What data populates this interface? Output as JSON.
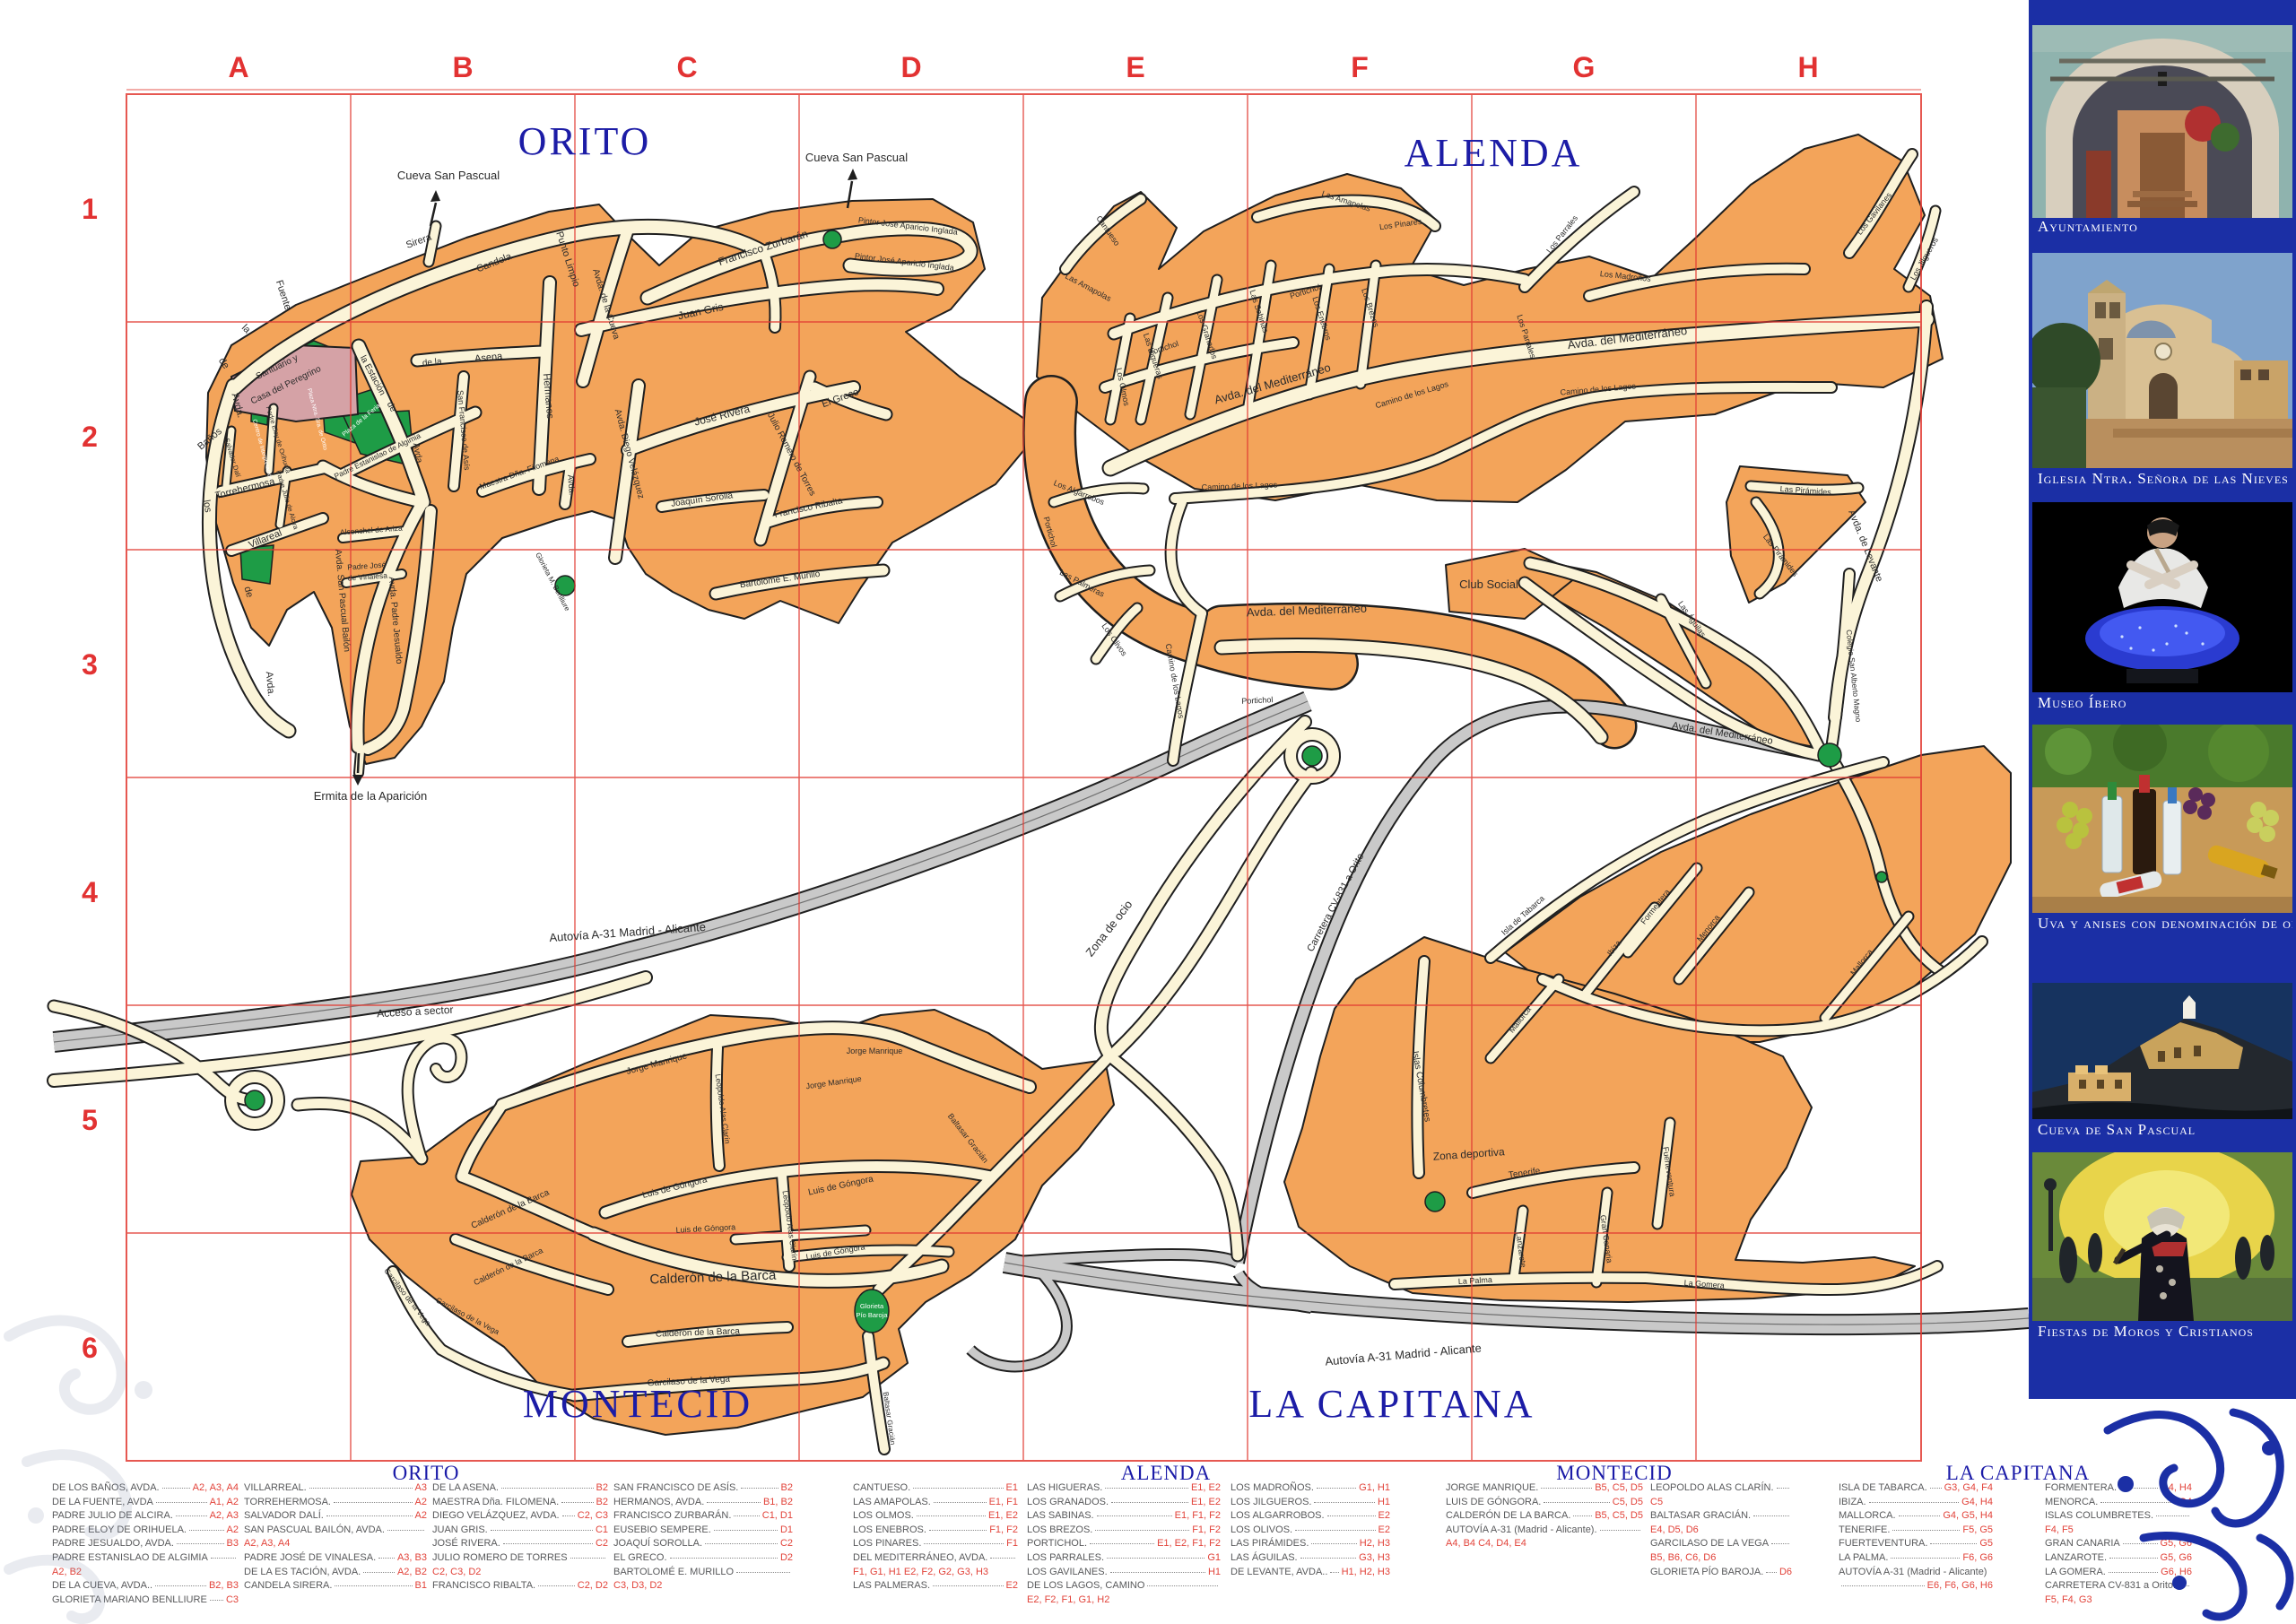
{
  "grid": {
    "columns": [
      "A",
      "B",
      "C",
      "D",
      "E",
      "F",
      "G",
      "H"
    ],
    "rows": [
      "1",
      "2",
      "3",
      "4",
      "5",
      "6"
    ]
  },
  "districts": {
    "orito": "ORITO",
    "alenda": "ALENDA",
    "montecid": "MONTECID",
    "capitana": "LA CAPITANA"
  },
  "colors": {
    "block_orange": "#F3A45A",
    "road_cream": "#FBF4D8",
    "grid_red": "#E23B33",
    "title_blue": "#1c1ca6",
    "park_green": "#1E9C46",
    "building_pink": "#D5A2A6",
    "highway_gray": "#C9C9C9",
    "sidebar_blue": "#1B2FA5",
    "index_ref_red": "#E2433A"
  },
  "map_labels": {
    "orito": {
      "cueva1": "Cueva San Pascual",
      "cueva2": "Cueva San Pascual",
      "sirera": "Sirera",
      "candela": "Candela",
      "punto": "Punto Limpio",
      "fzurbaran": "Francisco Zurbarán",
      "pintor1": "Pintor José Aparicio Inglada",
      "pintor2": "Pintor José Aparicio Inglada",
      "juangris": "Juan Gris",
      "cueva_av": "Avda. de la Cueva",
      "hermanos": "Hermanos",
      "asena": "Asena",
      "dela": "de la",
      "sanfran": "San Francisco de Asís",
      "maestra": "Maestra Dña. Filomena",
      "avda_c2": "Avda.",
      "joserivera": "José Rivera",
      "dvelazquez": "Avda. Diego Velázquez",
      "jromero": "Julio Romero de Torres",
      "elgreco": "El Greco",
      "fribalta": "Francisco Ribalta",
      "jsorolla": "Joaquín Sorolla",
      "bmurillo": "Bartolomé E. Murillo",
      "globen": "Glorieta M. Benlliure",
      "santuario_1": "Santuario y",
      "santuario_2": "Casa del Peregrino",
      "plazaferia": "Plaza de la Feria",
      "plazaorito": "Plaza Ntra. Sra. de Orito",
      "centro": "Centro de Interpretación",
      "fuente": "Fuente",
      "la2": "la",
      "de2": "de",
      "avda2": "Avda.",
      "banos": "Baños",
      "los2": "los",
      "de3": "de",
      "avda3": "Avda.",
      "torre": "Torrehermosa",
      "villareal": "Villareal",
      "spb": "Avda. San Pascual Bailón",
      "pjesualdo": "Avda. Padre Jesualdo",
      "alconchel": "Alconchel de Ariza",
      "vinalesa_1": "Padre José",
      "vinalesa_2": "de Vinalesa",
      "estanislao": "Padre Estanislao de Algimia",
      "eloy": "Padre Eloy de Orihuela",
      "dali": "Salvador Dalí",
      "alcira": "Padre Julio de Alcira",
      "estacion": "la Estación",
      "de4": "de",
      "avda4": "Avda.",
      "ermita": "Ermita de la Aparición"
    },
    "alenda": {
      "cantueso": "Cantueso",
      "amapolas1": "Las Amapolas",
      "amapolas2": "Las Amapolas",
      "higueras": "Las Higueras",
      "granados": "Los Granados",
      "sabinas": "Las Sabinas",
      "enebros": "Los Enebros",
      "brezos": "Los Brezos",
      "olmos": "Los Olmos",
      "pinares": "Los Pinares",
      "portichol1": "Portichol",
      "portichol2": "Portichol",
      "portichol3": "Portichol",
      "portichol4": "Portichol",
      "medit1": "Avda. del Mediterráneo",
      "medit2": "Avda. del Mediterráneo",
      "medit3": "Avda. del Mediterráneo",
      "medit4": "Avda. del Mediterráneo",
      "camino1": "Camino de los Lagos",
      "camino2": "Camino de los Lagos",
      "camino3": "Camino de los Lagos",
      "camino4": "Camino de los Lagos",
      "parrales1": "Los Parrales",
      "parrales2": "Los Parrales",
      "madronos": "Los Madroños",
      "gavilanes": "Los Gavilanes",
      "jilgueros": "Los Jilgueros",
      "algarrobos": "Los Algarrobos",
      "palmeras": "Las Palmeras",
      "olivos": "Los Olivos",
      "club": "Club Social",
      "piramides1": "Las Pirámides",
      "piramides2": "Las Pirámides",
      "levante": "Avda. de Levante",
      "aguilas": "Las Águilas",
      "colegio": "Colegio San Alberto Magno"
    },
    "montecid": {
      "autovia1": "Autovía A-31 Madrid - Alicante",
      "acceso": "Acceso a sector",
      "zonaocio": "Zona de ocio",
      "jorge1": "Jorge Manrique",
      "jorge2": "Jorge Manrique",
      "jorge3": "Jorge Manrique",
      "leopoldo1": "Leopoldo Alas Clarín",
      "leopoldo2": "Leopoldo Alas Clarín",
      "gongora1": "Luis de Góngora",
      "gongora2": "Luis de Góngora",
      "gongora3": "Luis de Góngora",
      "gongora4": "Luis de Góngora",
      "calderon1": "Calderón de la Barca",
      "calderon2": "Calderón de la Barca",
      "calderon3": "Calderón de la Barca",
      "calderon4": "Calderón de la Barca",
      "garcilaso1": "Garcilaso de la Vega",
      "garcilaso2": "Garcilaso de la Vega",
      "garcilaso3": "Garcilaso de la Vega",
      "baltasar1": "Baltasar Gracián",
      "baltasar2": "Baltasar Gracián",
      "gpb_1": "Glorieta",
      "gpb_2": "Pío Baroja"
    },
    "capitana": {
      "carretera": "Carretera CV-831 a Orito",
      "tabarca": "Isla de Tabarca",
      "formentera": "Formentera",
      "ibiza": "Ibiza",
      "menorca": "Menorca",
      "mallorca1": "Mallorca",
      "mallorca2": "Mallorca",
      "columbretes": "Islas Columbretes",
      "zonadep": "Zona deportiva",
      "tenerife": "Tenerife",
      "lanzarote": "Lanzarote",
      "grancanaria": "Gran Canaria",
      "fuerteventura": "Fuerteventura",
      "lapalma": "La Palma",
      "lagomera": "La Gomera",
      "autovia2": "Autovía A-31 Madrid - Alicante"
    }
  },
  "index": {
    "orito": [
      [
        {
          "n": "DE LOS BAÑOS, AVDA.",
          "r": "A2, A3, A4"
        },
        {
          "n": "DE LA FUENTE, AVDA",
          "r": "A1, A2"
        },
        {
          "n": "PADRE JULIO DE ALCIRA.",
          "r": "A2, A3"
        },
        {
          "n": "PADRE ELOY DE ORIHUELA.",
          "r": "A2"
        },
        {
          "n": "PADRE JESUALDO, AVDA.",
          "r": "B3"
        },
        {
          "n": "PADRE ESTANISLAO DE ALGIMIA",
          "r": "A2, B2"
        },
        {
          "n": "DE LA CUEVA, AVDA..",
          "r": "B2, B3"
        },
        {
          "n": "GLORIETA MARIANO BENLLIURE",
          "r": "C3"
        }
      ],
      [
        {
          "n": "VILLARREAL.",
          "r": "A3"
        },
        {
          "n": "TORREHERMOSA.",
          "r": "A2"
        },
        {
          "n": "SALVADOR DALÍ.",
          "r": "A2"
        },
        {
          "n": "SAN PASCUAL BAILÓN, AVDA.",
          "r": "A2, A3, A4"
        },
        {
          "n": "PADRE JOSÉ DE VINALESA.",
          "r": "A3, B3"
        },
        {
          "n": "DE LA ES TACIÓN, AVDA.",
          "r": "A2, B2"
        },
        {
          "n": "CANDELA SIRERA.",
          "r": "B1"
        }
      ],
      [
        {
          "n": "DE LA ASENA.",
          "r": "B2"
        },
        {
          "n": "MAESTRA Dña. FILOMENA.",
          "r": "B2"
        },
        {
          "n": "DIEGO VELÁZQUEZ, AVDA.",
          "r": "C2, C3"
        },
        {
          "n": "JUAN GRIS.",
          "r": "C1"
        },
        {
          "n": "JOSÉ RIVERA.",
          "r": "C2"
        },
        {
          "n": "JULIO ROMERO DE TORRES",
          "r": "C2, C3, D2"
        },
        {
          "n": "FRANCISCO RIBALTA.",
          "r": "C2, D2"
        }
      ],
      [
        {
          "n": "SAN FRANCISCO DE ASÍS.",
          "r": "B2"
        },
        {
          "n": "HERMANOS, AVDA.",
          "r": "B1, B2"
        },
        {
          "n": "FRANCISCO ZURBARÁN.",
          "r": "C1, D1"
        },
        {
          "n": "EUSEBIO SEMPERE.",
          "r": "D1"
        },
        {
          "n": "JOAQUÍ SOROLLA.",
          "r": "C2"
        },
        {
          "n": "EL GRECO.",
          "r": "D2"
        },
        {
          "n": "BARTOLOMÉ E. MURILLO",
          "r": "C3, D3, D2"
        }
      ]
    ],
    "alenda": [
      [
        {
          "n": "CANTUESO.",
          "r": "E1"
        },
        {
          "n": "LAS AMAPOLAS.",
          "r": "E1, F1"
        },
        {
          "n": "LOS OLMOS.",
          "r": "E1, E2"
        },
        {
          "n": "LOS ENEBROS.",
          "r": "F1, F2"
        },
        {
          "n": "LOS PINARES.",
          "r": "F1"
        },
        {
          "n": "DEL MEDITERRÁNEO, AVDA.",
          "r": "F1, G1, H1 E2, F2, G2, G3, H3"
        },
        {
          "n": "LAS PALMERAS.",
          "r": "E2"
        }
      ],
      [
        {
          "n": "LAS HIGUERAS.",
          "r": "E1, E2"
        },
        {
          "n": "LOS GRANADOS.",
          "r": "E1, E2"
        },
        {
          "n": "LAS SABINAS.",
          "r": "E1, F1, F2"
        },
        {
          "n": "LOS BREZOS.",
          "r": "F1, F2"
        },
        {
          "n": "PORTICHOL.",
          "r": "E1, E2, F1, F2"
        },
        {
          "n": "LOS PARRALES.",
          "r": "G1"
        },
        {
          "n": "LOS GAVILANES.",
          "r": "H1"
        },
        {
          "n": "DE LOS LAGOS, CAMINO",
          "r": "E2, F2, F1, G1, H2"
        }
      ],
      [
        {
          "n": "LOS MADROÑOS.",
          "r": "G1, H1"
        },
        {
          "n": "LOS JILGUEROS.",
          "r": "H1"
        },
        {
          "n": "LOS ALGARROBOS.",
          "r": "E2"
        },
        {
          "n": "LOS OLIVOS.",
          "r": "E2"
        },
        {
          "n": "LAS PIRÁMIDES.",
          "r": "H2, H3"
        },
        {
          "n": "LAS ÁGUILAS.",
          "r": "G3, H3"
        },
        {
          "n": "DE LEVANTE, AVDA..",
          "r": "H1, H2, H3"
        }
      ]
    ],
    "montecid": [
      [
        {
          "n": "JORGE MANRIQUE.",
          "r": "B5, C5, D5"
        },
        {
          "n": "LUIS DE GÓNGORA.",
          "r": "C5, D5"
        },
        {
          "n": "CALDERÓN DE LA BARCA.",
          "r": "B5, C5, D5"
        },
        {
          "n": "AUTOVÍA A-31 (Madrid - Alicante).",
          "r": "A4, B4 C4, D4, E4"
        }
      ],
      [
        {
          "n": "LEOPOLDO ALAS CLARÍN.",
          "r": "C5"
        },
        {
          "n": "BALTASAR GRACIÁN.",
          "r": "E4, D5, D6"
        },
        {
          "n": "GARCILASO DE LA VEGA",
          "r": "B5, B6, C6, D6"
        },
        {
          "n": "GLORIETA PÍO BAROJA.",
          "r": "D6"
        }
      ]
    ],
    "capitana": [
      [
        {
          "n": "ISLA DE TABARCA.",
          "r": "G3, G4, F4"
        },
        {
          "n": "IBIZA.",
          "r": "G4, H4"
        },
        {
          "n": "MALLORCA.",
          "r": "G4, G5, H4"
        },
        {
          "n": "TENERIFE.",
          "r": "F5, G5"
        },
        {
          "n": "FUERTEVENTURA.",
          "r": "G5"
        },
        {
          "n": "LA PALMA.",
          "r": "F6, G6"
        },
        {
          "n": "AUTOVÍA A-31 (Madrid - Alicante)",
          "r": "E6, F6, G6, H6"
        }
      ],
      [
        {
          "n": "FORMENTERA.",
          "r": "G4, H4"
        },
        {
          "n": "MENORCA.",
          "r": "G4"
        },
        {
          "n": "ISLAS COLUMBRETES.",
          "r": "F4, F5"
        },
        {
          "n": "GRAN CANARIA",
          "r": "G5, G6"
        },
        {
          "n": "LANZAROTE.",
          "r": "G5, G6"
        },
        {
          "n": "LA GOMERA.",
          "r": "G6, H6"
        },
        {
          "n": "CARRETERA CV-831 a Orito.",
          "r": "F5, F4, G3"
        }
      ]
    ]
  },
  "sidebar": {
    "panels": [
      {
        "caption": "Ayuntamiento"
      },
      {
        "caption": "Iglesia Ntra. Señora de las Nieves"
      },
      {
        "caption": "Museo Íbero"
      },
      {
        "caption": "Uva y anises con denominación de origen"
      },
      {
        "caption": "Cueva de San Pascual"
      },
      {
        "caption": "Fiestas de Moros y Cristianos"
      }
    ]
  }
}
